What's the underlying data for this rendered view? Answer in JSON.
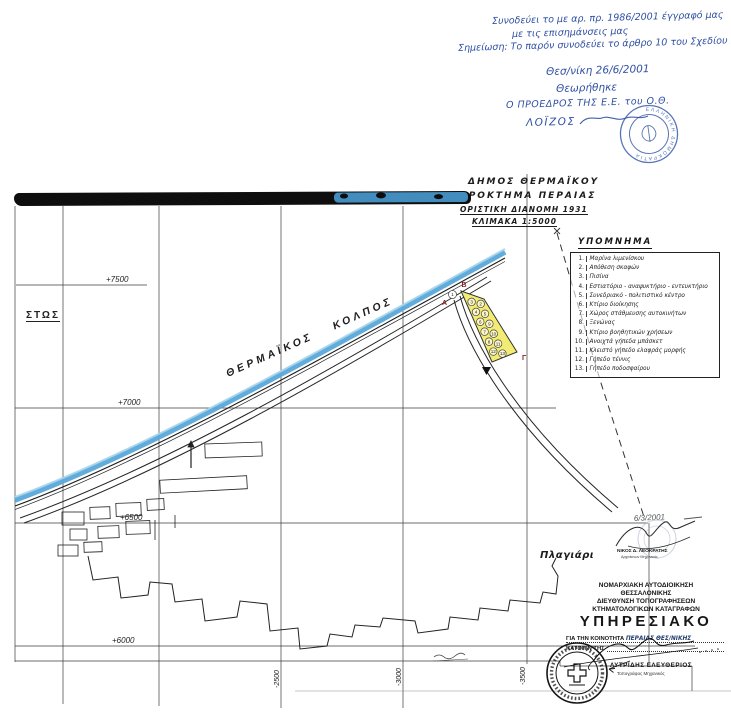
{
  "colors": {
    "ink_blue": "#2e4fa3",
    "stamp_blue": "#3b5cad",
    "coast_blue": "#58a8d8",
    "highlight_yellow": "#f2ec74",
    "mark_red": "#8b2420"
  },
  "top_annotation": {
    "line1": "Συνοδεύει το με αρ. πρ. 1986/2001 έγγραφό μας",
    "line2": "με τις επισημάνσεις μας",
    "line3": "Σημείωση: Το παρόν συνοδεύει το άρθρο 10 του Σχεδίου Νόμου",
    "date_place": "Θεσ/νίκη 26/6/2001",
    "approval": "Θεωρήθηκε",
    "signer_title": "Ο ΠΡΟΕΔΡΟΣ ΤΗΣ Ε.Ε. του Ο.Θ.",
    "signer_name": "ΛΟΪΖΟΣ",
    "stamp_text": "ΕΛΛΗΝΙΚΗ ΔΗΜΟΚΡΑΤΙΑ"
  },
  "map_title": {
    "line1": "ΔΗΜΟΣ ΘΕΡΜΑΪΚΟΥ",
    "line2": "ΑΓΡΟΚΤΗΜΑ ΠΕΡΑΙΑΣ",
    "line3": "ΟΡΙΣΤΙΚΗ ΔΙΑΝΟΜΗ 1931",
    "line4": "ΚΛΙΜΑΚΑ 1:5000"
  },
  "legend": {
    "title": "ΥΠΟΜΝΗΜΑ",
    "items": [
      {
        "n": "1.",
        "label": "Μαρίνα λιμενίσκου"
      },
      {
        "n": "2.",
        "label": "Απόθεση σκαφών"
      },
      {
        "n": "3.",
        "label": "Πισίνα"
      },
      {
        "n": "4.",
        "label": "Εστιατόριο - αναψυκτήριο - εντευκτήριο"
      },
      {
        "n": "5.",
        "label": "Συνεδριακό - πολιτιστικό κέντρο"
      },
      {
        "n": "6.",
        "label": "Κτίριο διοίκησης"
      },
      {
        "n": "7.",
        "label": "Χώρος στάθμευσης αυτοκινήτων"
      },
      {
        "n": "8.",
        "label": "Ξενώνας"
      },
      {
        "n": "9.",
        "label": "Κτίριο βοηθητικών χρήσεων"
      },
      {
        "n": "10.",
        "label": "Ανοιχτά γήπεδα μπάσκετ"
      },
      {
        "n": "11.",
        "label": "Κλειστό γήπεδο ελαφράς μορφής"
      },
      {
        "n": "12.",
        "label": "Γήπεδο τέννις"
      },
      {
        "n": "13.",
        "label": "Γήπεδο ποδοσφαίρου"
      }
    ]
  },
  "map": {
    "sea_label": "ΘΕΡΜΑΪΚΟΣ ΚΟΛΠΟΣ",
    "left_coords": [
      "+7500",
      "+7000",
      "+6500",
      "+6000"
    ],
    "bottom_coords": [
      "-2500",
      "-3000",
      "-3500"
    ],
    "partial_left_label": "ΣΤΩΣ",
    "village_label": "Πλαγιάρι",
    "date_note": "6/3/2001",
    "checker_name": "ΝΙΚΟΣ Δ. ΛΕΟΚΡΑΤΗΣ",
    "checker_title": "Αρχιτέκτων Μηχανικός"
  },
  "marina": {
    "corner_labels": [
      "Α",
      "Β",
      "Γ"
    ],
    "outside_number": "1",
    "left_numbers": [
      "3",
      "4",
      "6",
      "7",
      "8",
      "12"
    ],
    "right_numbers": [
      "2",
      "5",
      "9",
      "10",
      "11",
      "13"
    ]
  },
  "office_block": {
    "line1": "ΝΟΜΑΡΧΙΑΚΗ ΑΥΤΟΔΙΟΙΚΗΣΗ",
    "line2": "ΘΕΣΣΑΛΟΝΙΚΗΣ",
    "line3": "ΔΙΕΥΘΥΝΣΗ ΤΟΠΟΓΡΑΦΗΣΕΩΝ",
    "line4": "ΚΤΗΜΑΤΟΛΟΓΙΚΩΝ ΚΑΤΑΓΡΑΦΩΝ",
    "doc_type": "ΥΠΗΡΕΣΙΑΚΟ",
    "for_printed": "ΓΙΑ ΤΗΝ ΚΟΙΝΟΤΗΤΑ",
    "for_handwritten": "ΠΕΡΑΙΑΣ ΘΕΣ/ΝΙΚΗΣ",
    "katopin": "ΚΑΤΟΠΙΝ ΤΗΣ",
    "signer_name": "ΛΥΤΡΙΔΗΣ ΕΛΕΥΘΕΡΙΟΣ",
    "signer_title": "Τοπογράφος Μηχανικός"
  }
}
